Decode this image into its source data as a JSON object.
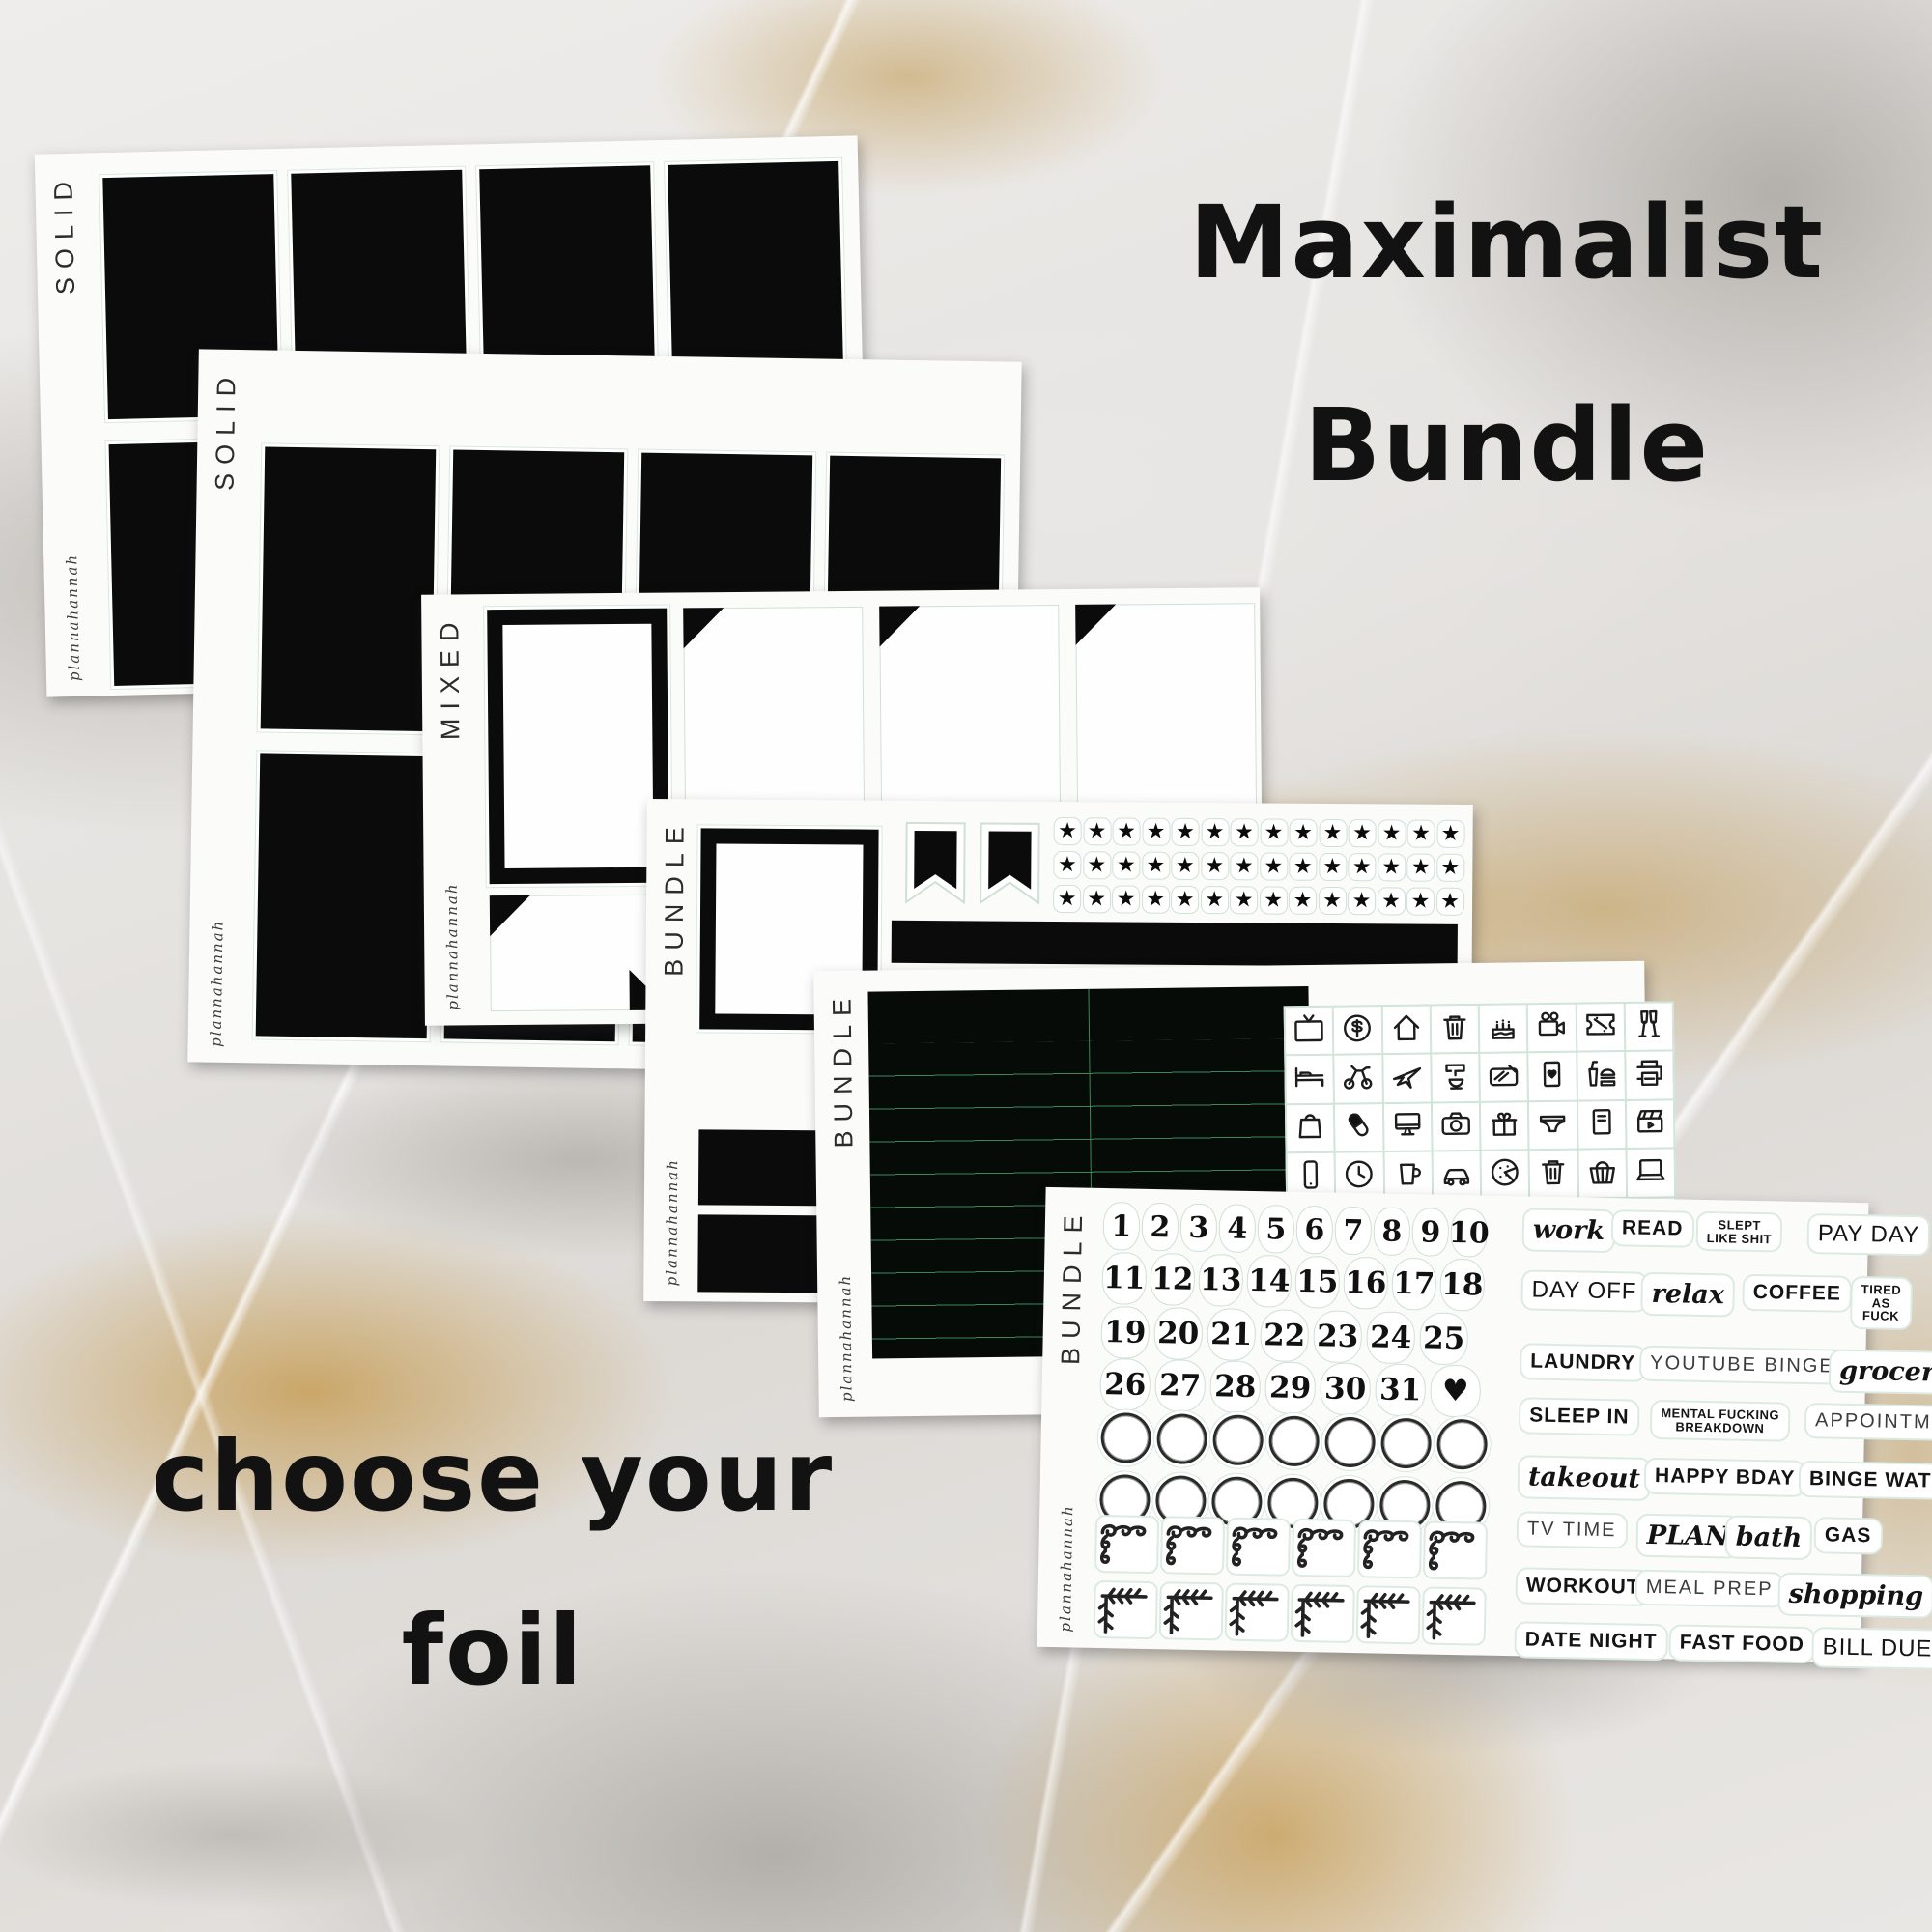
{
  "title": {
    "line1": "Maximalist",
    "line2": "Bundle"
  },
  "caption": {
    "line1": "choose your",
    "line2": "foil"
  },
  "brand": "plannahannah",
  "colors": {
    "black": "#0b0b0c",
    "sticker_outline": "#d9e8df",
    "line_green": "#3e9664",
    "gold": "#c59a4e",
    "sheet_white": "#fbfbfa"
  },
  "sheets": [
    {
      "label": "SOLID",
      "description": "full solid black boxes, 2 rows x 4"
    },
    {
      "label": "SOLID",
      "description": "full solid black boxes, 2 rows x 4"
    },
    {
      "label": "MIXED",
      "description": "white frame box + corner-triangle boxes"
    },
    {
      "label": "BUNDLE",
      "description": "frame box, 2 pennant flags, 3 rows of 14 stars, black header bars"
    },
    {
      "label": "BUNDLE",
      "description": "black lined list box + 5x8 icon grid"
    },
    {
      "label": "BUNDLE",
      "description": "date numbers 1-31, circles, corner doodles, word stickers"
    }
  ],
  "bundle_sheet": {
    "star_rows": 3,
    "stars_per_row": 14,
    "flag_count": 2,
    "circle_rows": 2,
    "circles_per_row": 7,
    "swirl_corners": 6,
    "leaf_corners": 6,
    "number_rows": [
      [
        "1",
        "2",
        "3",
        "4",
        "5",
        "6",
        "7",
        "8",
        "9",
        "10"
      ],
      [
        "11",
        "12",
        "13",
        "14",
        "15",
        "16",
        "17",
        "18"
      ],
      [
        "19",
        "20",
        "21",
        "22",
        "23",
        "24",
        "25"
      ],
      [
        "26",
        "27",
        "28",
        "29",
        "30",
        "31",
        "♥"
      ]
    ],
    "word_rows": [
      [
        {
          "t": "work",
          "s": "script"
        },
        {
          "t": "READ",
          "s": "caps"
        },
        {
          "t": "SLEPT\nLIKE SHIT",
          "s": "two"
        },
        {
          "t": "PAY DAY",
          "s": "tall"
        }
      ],
      [
        {
          "t": "DAY OFF",
          "s": "tall"
        },
        {
          "t": "relax",
          "s": "script"
        },
        {
          "t": "COFFEE",
          "s": "caps"
        },
        {
          "t": "TIRED\nAS FUCK",
          "s": "two"
        }
      ],
      [
        {
          "t": "LAUNDRY",
          "s": "caps"
        },
        {
          "t": "YOUTUBE BINGE",
          "s": "thin"
        },
        {
          "t": "groceries",
          "s": "script"
        }
      ],
      [
        {
          "t": "SLEEP IN",
          "s": "caps"
        },
        {
          "t": "MENTAL FUCKING\nBREAKDOWN",
          "s": "two"
        },
        {
          "t": "APPOINTMENT",
          "s": "thin"
        }
      ],
      [
        {
          "t": "takeout",
          "s": "script"
        },
        {
          "t": "HAPPY BDAY",
          "s": "caps"
        },
        {
          "t": "BINGE WATCH",
          "s": "caps"
        }
      ],
      [
        {
          "t": "TV TIME",
          "s": "thin"
        },
        {
          "t": "PLAN",
          "s": "script"
        },
        {
          "t": "bath",
          "s": "script"
        },
        {
          "t": "GAS",
          "s": "caps"
        }
      ],
      [
        {
          "t": "WORKOUT",
          "s": "caps"
        },
        {
          "t": "MEAL PREP",
          "s": "thin"
        },
        {
          "t": "shopping",
          "s": "script"
        }
      ],
      [
        {
          "t": "DATE NIGHT",
          "s": "caps"
        },
        {
          "t": "FAST FOOD",
          "s": "caps"
        },
        {
          "t": "BILL DUE",
          "s": "tall"
        }
      ]
    ]
  },
  "icon_grid": [
    [
      "tv-icon",
      "money-icon",
      "house-icon",
      "trash-can-icon",
      "birthday-cake-icon",
      "video-camera-icon",
      "ticket-icon",
      "champagne-icon"
    ],
    [
      "bed-icon",
      "exercise-bike-icon",
      "airplane-icon",
      "stand-mixer-icon",
      "cooking-icon",
      "playing-card-icon",
      "fast-food-icon",
      "printer-icon"
    ],
    [
      "shopping-bag-icon",
      "pill-icon",
      "desktop-computer-icon",
      "camera-icon",
      "gift-icon",
      "underwear-icon",
      "notebook-icon",
      "clapperboard-icon"
    ],
    [
      "phone-icon",
      "clock-icon",
      "mug-icon",
      "car-icon",
      "pizza-icon",
      "trash-can-icon",
      "laundry-basket-icon",
      "laptop-icon"
    ],
    [
      "envelope-icon",
      "heart-icon",
      "coffee-cup-icon",
      "ring-icon",
      "stethoscope-icon",
      "shopping-cart-icon",
      "dinner-plate-icon",
      "paw-print-icon"
    ]
  ]
}
